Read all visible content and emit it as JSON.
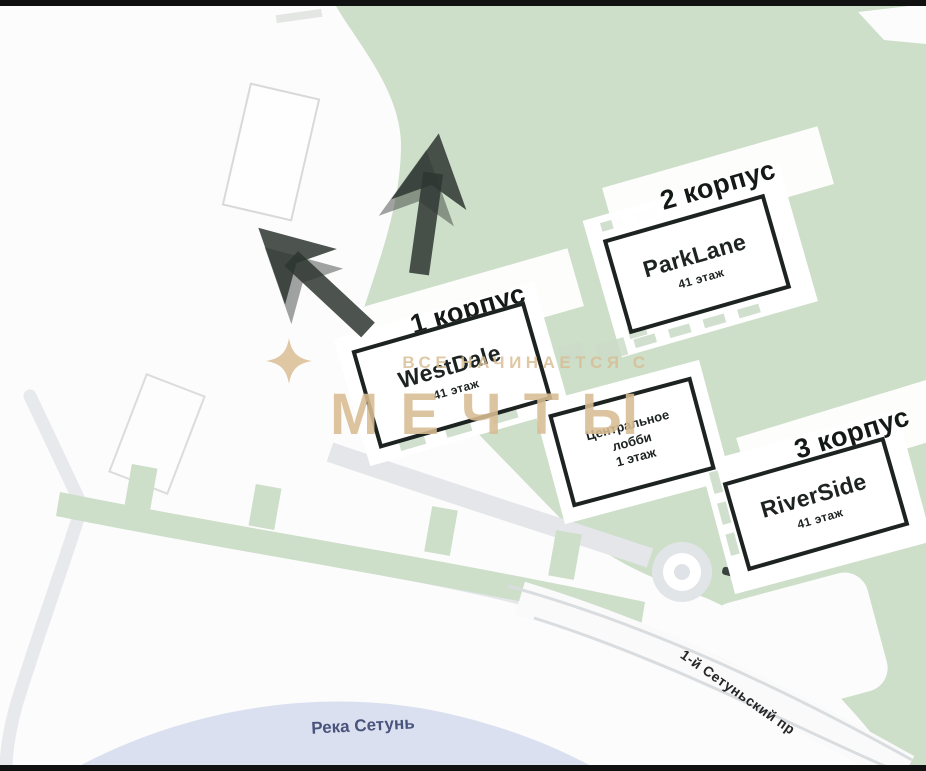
{
  "map": {
    "watermark": {
      "tagline": "ВСЕ НАЧИНАЕТСЯ С",
      "brand": "МЕЧТЫ"
    },
    "labels": {
      "river": "Река Сетунь",
      "road": "1-й Сетуньский пр"
    },
    "buildings": {
      "corpus1": {
        "title": "1 корпус",
        "name": "WestDale",
        "floors": "41 этаж"
      },
      "corpus2": {
        "title": "2 корпус",
        "name": "ParkLane",
        "floors": "41 этаж"
      },
      "corpus3": {
        "title": "3 корпус",
        "name": "RiverSide",
        "floors": "41 этаж"
      },
      "lobby": {
        "line1": "Центральное",
        "line2": "лобби",
        "line3": "1 этаж"
      }
    },
    "colors": {
      "park_green": "#cddec9",
      "river_blue": "#dbe0f1",
      "road_gray": "#e4e6e9",
      "watermark_tan": "#d9bd93",
      "arrow_dark": "#2e3631",
      "frame_black": "#111111"
    }
  }
}
